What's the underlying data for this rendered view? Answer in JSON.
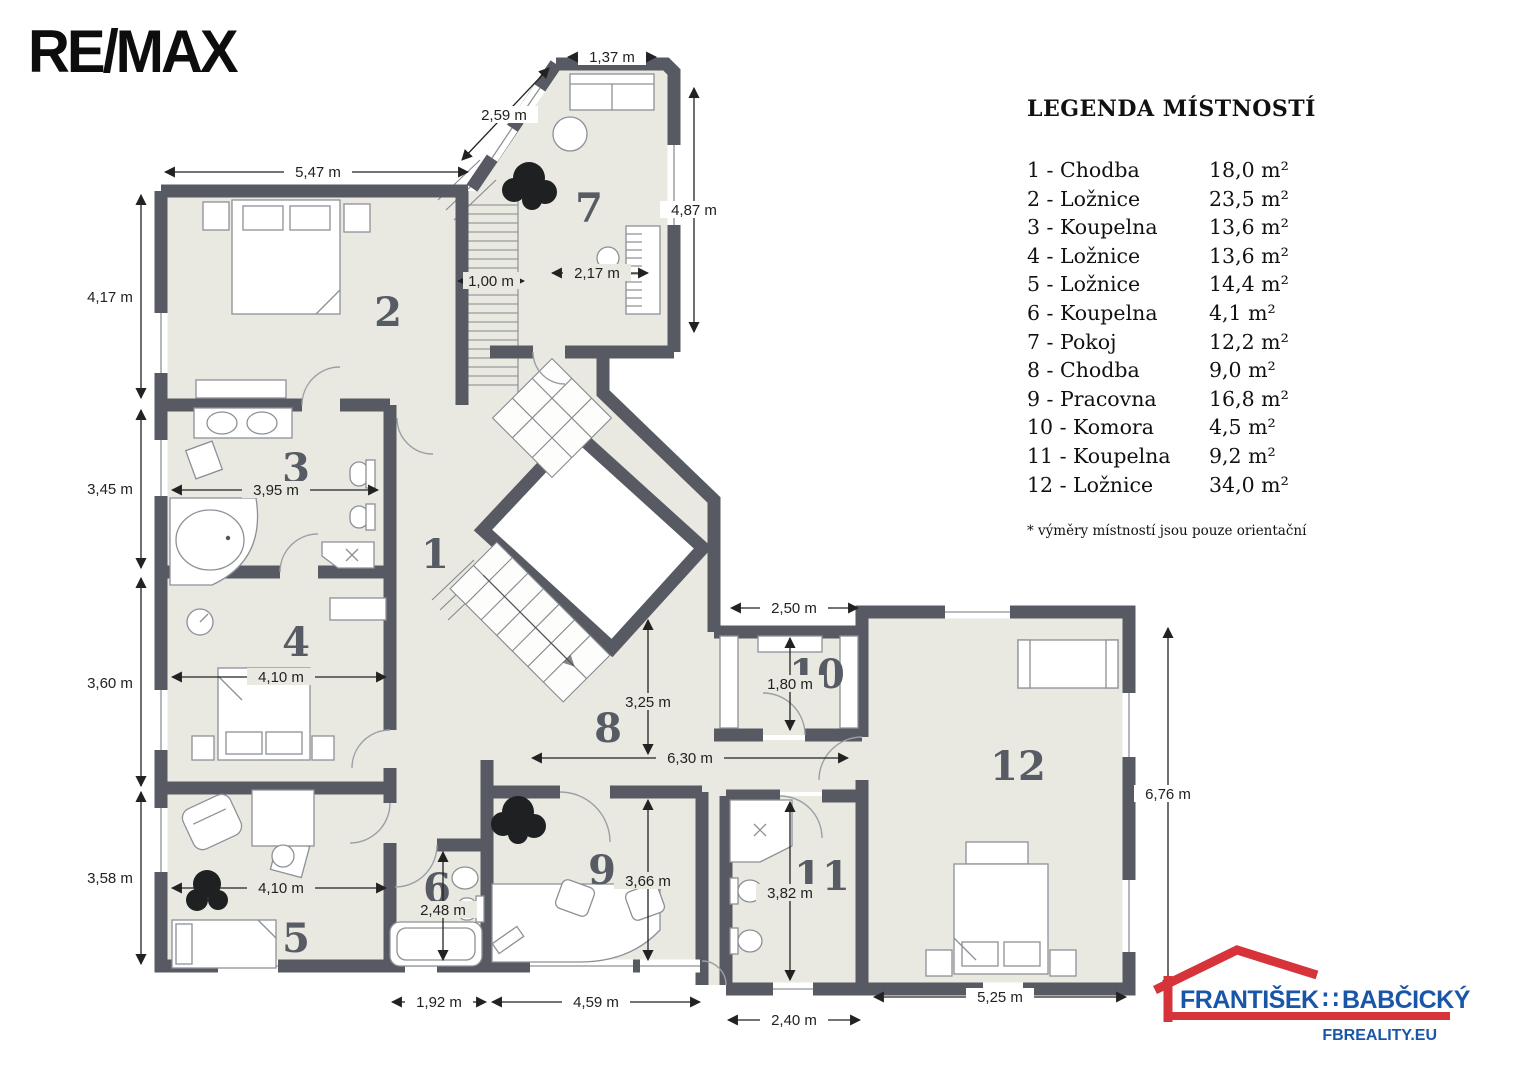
{
  "branding": {
    "remax": "RE/MAX",
    "agent": {
      "first": "FRANTIŠEK",
      "separator": "∷",
      "last": "BABČICKÝ",
      "website": "FBREALITY.EU",
      "roof_color": "#d6333a",
      "text_color": "#1a56a8"
    }
  },
  "legend": {
    "title": "LEGENDA MÍSTNOSTÍ",
    "rows": [
      {
        "label": "1 - Chodba",
        "area": "18,0 m²"
      },
      {
        "label": "2 - Ložnice",
        "area": "23,5 m²"
      },
      {
        "label": "3 - Koupelna",
        "area": "13,6 m²"
      },
      {
        "label": "4 - Ložnice",
        "area": "13,6 m²"
      },
      {
        "label": "5 - Ložnice",
        "area": "14,4 m²"
      },
      {
        "label": "6 - Koupelna",
        "area": "4,1 m²"
      },
      {
        "label": "7 - Pokoj",
        "area": "12,2 m²"
      },
      {
        "label": "8 - Chodba",
        "area": "9,0 m²"
      },
      {
        "label": "9 - Pracovna",
        "area": "16,8 m²"
      },
      {
        "label": "10 - Komora",
        "area": "4,5 m²"
      },
      {
        "label": "11 - Koupelna",
        "area": "9,2 m²"
      },
      {
        "label": "12 - Ložnice",
        "area": "34,0 m²"
      }
    ],
    "footnote": "* výměry místností jsou pouze orientační"
  },
  "plan": {
    "colors": {
      "wall": "#575a62",
      "floor": "#e9e9e2",
      "room_number": "#575b64"
    },
    "rooms": [
      {
        "number": "1"
      },
      {
        "number": "2"
      },
      {
        "number": "3"
      },
      {
        "number": "4"
      },
      {
        "number": "5"
      },
      {
        "number": "6"
      },
      {
        "number": "7"
      },
      {
        "number": "8"
      },
      {
        "number": "9"
      },
      {
        "number": "10"
      },
      {
        "number": "11"
      },
      {
        "number": "12"
      }
    ],
    "dimensions": [
      {
        "label": "5,47 m"
      },
      {
        "label": "2,59 m"
      },
      {
        "label": "1,37 m"
      },
      {
        "label": "4,87 m"
      },
      {
        "label": "2,17 m"
      },
      {
        "label": "1,00 m"
      },
      {
        "label": "4,17 m"
      },
      {
        "label": "3,45 m"
      },
      {
        "label": "3,60 m"
      },
      {
        "label": "3,58 m"
      },
      {
        "label": "3,95 m"
      },
      {
        "label": "4,10 m"
      },
      {
        "label": "4,10 m"
      },
      {
        "label": "2,48 m"
      },
      {
        "label": "1,92 m"
      },
      {
        "label": "4,59 m"
      },
      {
        "label": "2,40 m"
      },
      {
        "label": "5,25 m"
      },
      {
        "label": "2,50 m"
      },
      {
        "label": "1,80 m"
      },
      {
        "label": "6,30 m"
      },
      {
        "label": "3,25 m"
      },
      {
        "label": "3,66 m"
      },
      {
        "label": "3,82 m"
      },
      {
        "label": "6,76 m"
      }
    ]
  }
}
